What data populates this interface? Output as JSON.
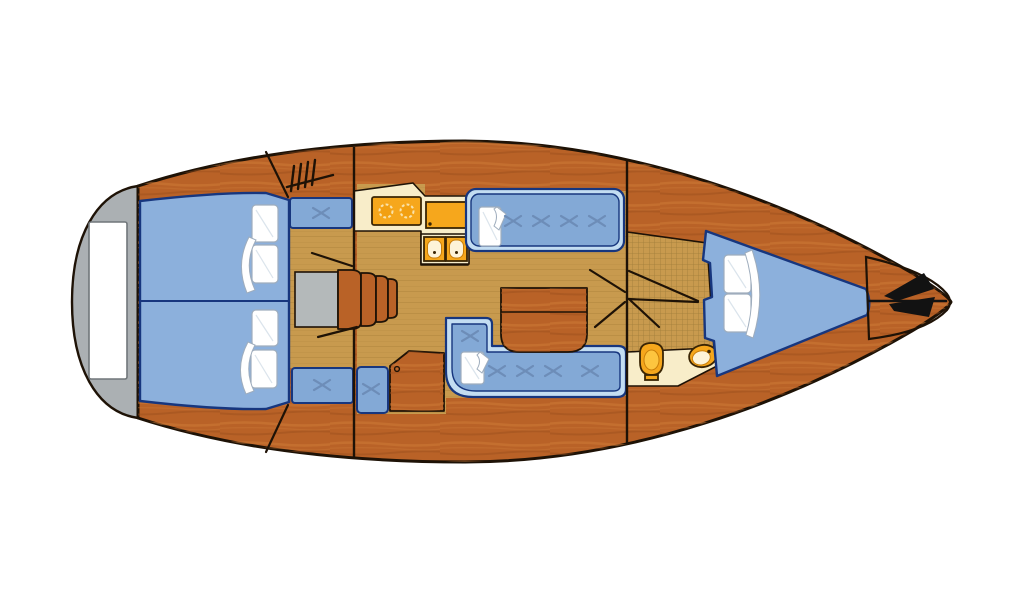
{
  "diagram": {
    "label": "Sailboat interior layout floor plan, top view, bow pointing right",
    "type": "boat-floor-plan"
  },
  "colors": {
    "hull": "#b96227",
    "hullStreakLight": "#cf7c38",
    "hullStreakDark": "#9a4d1d",
    "outline": "#1e1206",
    "floor": "#c89a4e",
    "floorSeam": "#a87f36",
    "grate": "#957434",
    "cream": "#f8edc9",
    "orange": "#f6a71c",
    "orangeDark": "#3a2504",
    "orangeLight": "#fdc53f",
    "burner": "#f2a012",
    "burnerRing": "#fae3ab",
    "basin": "#fdf3d8",
    "basinRim": "#c97f0a",
    "cushion": "#83a9d6",
    "cushionEdge": "#c3ddf2",
    "berth": "#8cb0dc",
    "navy": "#17367e",
    "stitch": "#6d8db8",
    "pillow": "#ffffff",
    "pillowShade": "#dbe4ec",
    "pillowLine": "#9fadbd",
    "gray": "#abb0b3",
    "grayDark": "#999ea1",
    "grayTip": "#f4f5f5",
    "stepGray": "#b4b9ba",
    "platform": "#ffffff",
    "platformRim": "#70767a",
    "anchor": "#121212"
  },
  "areas": {
    "swim_platform": {
      "name": "stern swim platform"
    },
    "aft_cabin": {
      "name": "aft double berth",
      "pillow_count": 4
    },
    "companionway": {
      "name": "companionway steps",
      "step_count": 4,
      "bench_count": 3
    },
    "galley": {
      "name": "L-shaped galley",
      "burner_count": 2,
      "sink_count": 2
    },
    "salon": {
      "name": "salon with settees and folding table",
      "settee_count": 2,
      "pillow_count": 2
    },
    "nav_station": {
      "name": "chart table with seat"
    },
    "head": {
      "name": "head with shower grate floor",
      "toilet_count": 1,
      "washbasin_count": 1
    },
    "v_berth": {
      "name": "forward V-berth",
      "pillow_count": 2
    },
    "anchor_locker": {
      "name": "bow anchor locker"
    }
  }
}
